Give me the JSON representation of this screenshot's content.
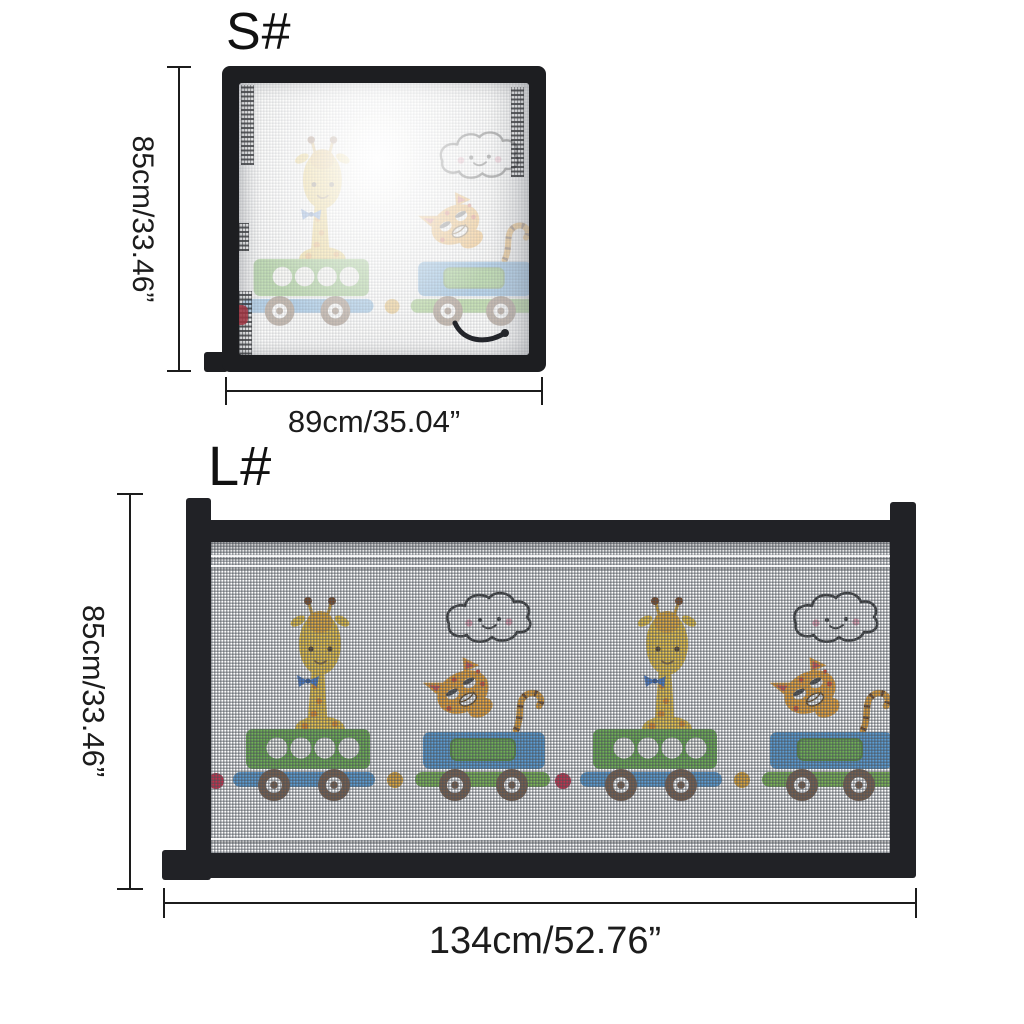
{
  "diagram_title": "pet safety gate size diagram",
  "sizes": [
    {
      "id": "S",
      "label": "S#",
      "height_label": "85cm/33.46”",
      "width_label": "89cm/35.04”"
    },
    {
      "id": "L",
      "label": "L#",
      "height_label": "85cm/33.46”",
      "width_label": "134cm/52.76”"
    }
  ],
  "artwork": {
    "motifs": [
      "giraffe",
      "cat",
      "smiling-cloud",
      "green-train-car",
      "blue-train-car",
      "brown-wheels",
      "connector-dots"
    ],
    "pattern": "cartoon animal train print on mesh"
  },
  "colors": {
    "frame_black": "#212226",
    "dimension_ink": "#1c1c1c",
    "car_green": "#6FB254",
    "car_blue": "#5B9ED6",
    "rail_green": "#7CB854",
    "wheel_brown": "#7A5F4C",
    "giraffe_yellow": "#EFC94C",
    "giraffe_spot_orange": "#E8932F",
    "cat_orange": "#F2A93C",
    "connector_yellow": "#E2A93B",
    "connector_red": "#C2314B",
    "cloud_outline": "#3A3A3A",
    "cheek_pink": "#E89BB0"
  }
}
